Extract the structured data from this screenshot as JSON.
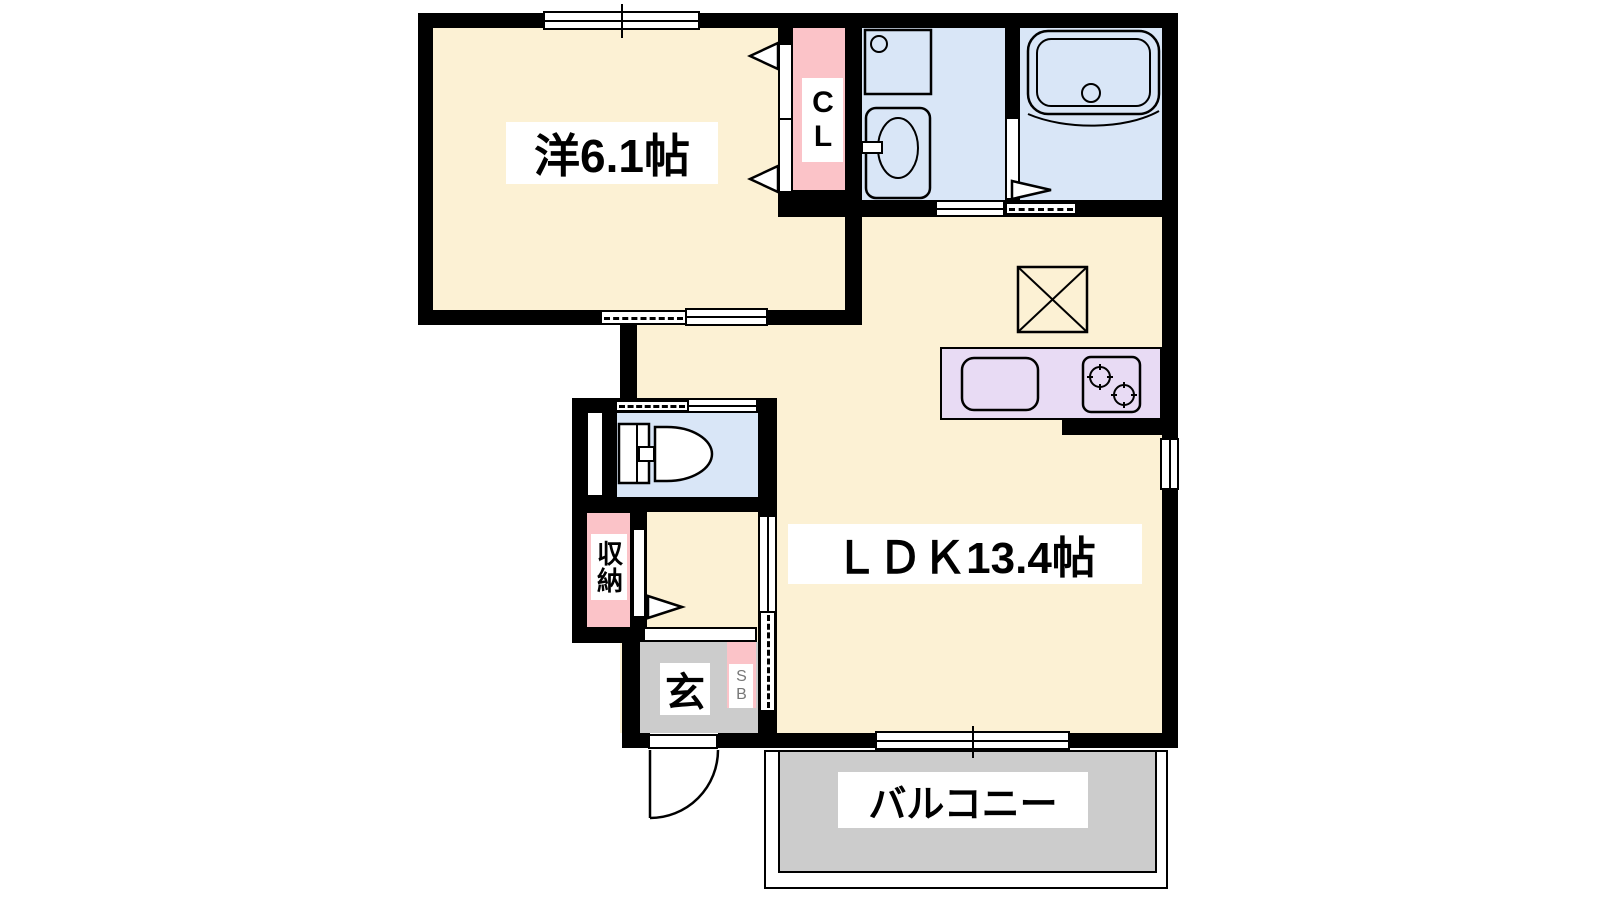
{
  "plan": {
    "type": "japanese-apartment-floorplan",
    "labels": {
      "western_room": "洋6.1帖",
      "ldk": "ＬＤＫ13.4帖",
      "closet": "CL",
      "storage": "収納",
      "entrance": "玄",
      "shoe_box": "SB",
      "balcony": "バルコニー"
    },
    "colors": {
      "floor": "#FCF1D4",
      "wet_area": "#D9E6F7",
      "closet": "#FBC3C8",
      "kitchen": "#E8DBF4",
      "entrance": "#CCCCCC",
      "balcony": "#CCCCCC",
      "wall": "#000000",
      "label_bg": "#FFFFFF",
      "sb_text": "#777777"
    }
  }
}
